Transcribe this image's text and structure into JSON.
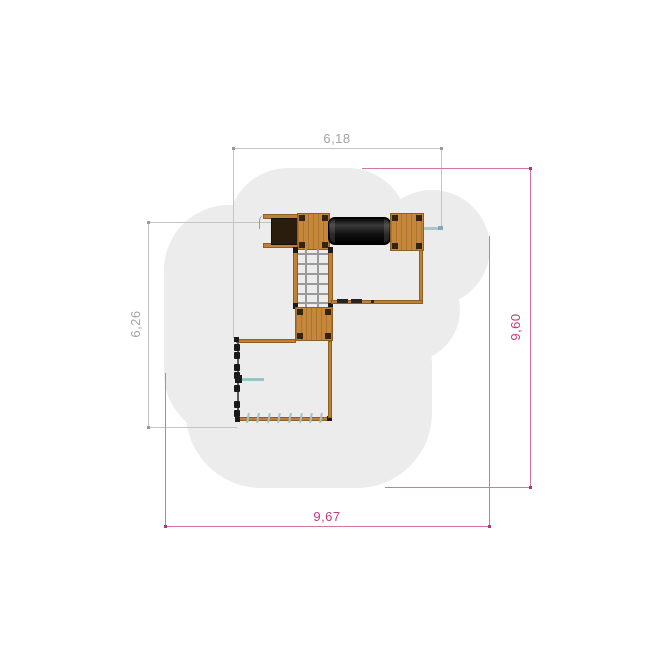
{
  "drawing": {
    "title": "playground-equipment-plan-view",
    "dimensions": {
      "top": {
        "label": "6,18",
        "unit": "m",
        "color": "gray"
      },
      "left": {
        "label": "6,26",
        "unit": "m",
        "color": "gray"
      },
      "right": {
        "label": "9,60",
        "unit": "m",
        "color": "magenta"
      },
      "bottom": {
        "label": "9,67",
        "unit": "m",
        "color": "magenta"
      }
    },
    "colors": {
      "safety_area": "#ececec",
      "wood": "#c5873c",
      "wood_border": "#8d6126",
      "tunnel": "#161616",
      "slide_dark": "#2a1d0d",
      "accent_teal": "#9cc4c4",
      "dim_gray_line": "#c4c4c4",
      "dim_gray_text": "#a3a3a3",
      "dim_magenta_line": "#d673a7",
      "dim_magenta_text": "#c7387f"
    },
    "components": [
      "safety-area",
      "slide",
      "platform-top-left",
      "crawl-tunnel",
      "platform-top-right",
      "steel-pole",
      "climbing-net",
      "platform-lower",
      "connecting-beam",
      "climbing-wall-grips",
      "balance-rope",
      "hand-bar"
    ]
  }
}
